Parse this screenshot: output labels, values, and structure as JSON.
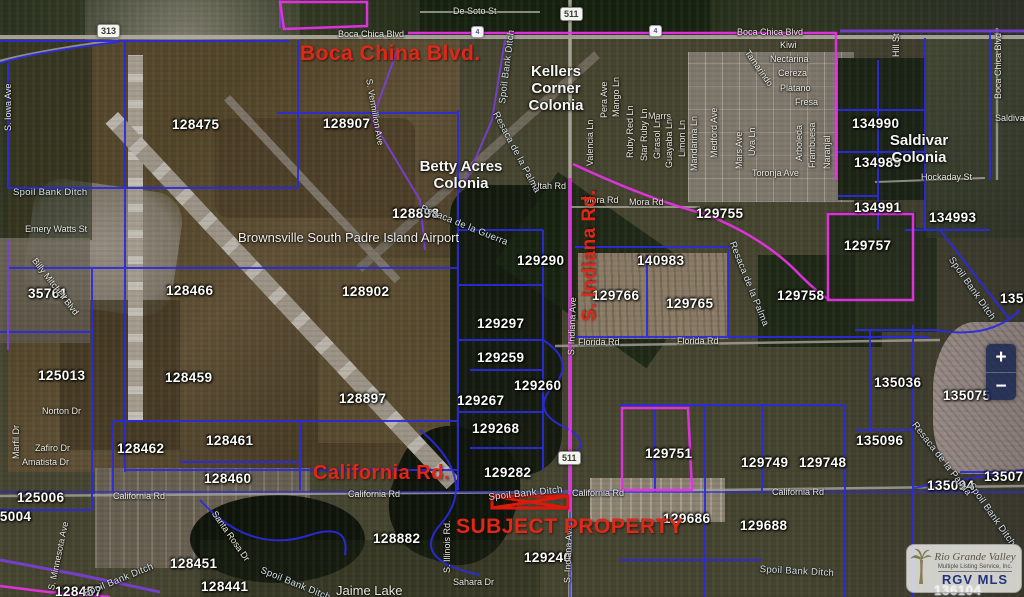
{
  "title": "RGV MLS parcel map - Brownsville South Padre Island Airport area",
  "colors": {
    "parcel_line": "#2b2be0",
    "highlight_magenta": "#e632e6",
    "purple_line": "#7a3fd8",
    "road_label_red": "#e02818",
    "shield_bg": "#f4f4ee",
    "subject_red": "#e0180c"
  },
  "controls": {
    "zoom_in": "+",
    "zoom_out": "−"
  },
  "logo": {
    "name": "Rio Grande Valley",
    "sub": "Multiple Listing Service, Inc.",
    "abbr": "RGV MLS"
  },
  "labels": {
    "reds": [
      {
        "t": "Boca China Blvd.",
        "x": 300,
        "y": 42,
        "s": 21
      },
      {
        "t": "California Rd.",
        "x": 313,
        "y": 462,
        "s": 20
      },
      {
        "t": "SUBJECT PROPERTY",
        "x": 456,
        "y": 515,
        "s": 21
      },
      {
        "t": "S. Indiana Rd.",
        "x": 579,
        "y": 322,
        "r": -90,
        "s": 19
      }
    ],
    "parcels": [
      {
        "t": "128475",
        "x": 172,
        "y": 117
      },
      {
        "t": "128907",
        "x": 323,
        "y": 116
      },
      {
        "t": "128898",
        "x": 392,
        "y": 206
      },
      {
        "t": "128466",
        "x": 166,
        "y": 283
      },
      {
        "t": "128902",
        "x": 342,
        "y": 284
      },
      {
        "t": "35761",
        "x": 28,
        "y": 286
      },
      {
        "t": "125013",
        "x": 38,
        "y": 368
      },
      {
        "t": "128459",
        "x": 165,
        "y": 370
      },
      {
        "t": "128897",
        "x": 339,
        "y": 391
      },
      {
        "t": "129290",
        "x": 517,
        "y": 253
      },
      {
        "t": "129297",
        "x": 477,
        "y": 316
      },
      {
        "t": "129259",
        "x": 477,
        "y": 350
      },
      {
        "t": "129260",
        "x": 514,
        "y": 378
      },
      {
        "t": "129267",
        "x": 457,
        "y": 393
      },
      {
        "t": "129268",
        "x": 472,
        "y": 421
      },
      {
        "t": "129282",
        "x": 484,
        "y": 465
      },
      {
        "t": "128462",
        "x": 117,
        "y": 441
      },
      {
        "t": "128461",
        "x": 206,
        "y": 433
      },
      {
        "t": "128460",
        "x": 204,
        "y": 471
      },
      {
        "t": "125006",
        "x": 17,
        "y": 490
      },
      {
        "t": "125004",
        "x": -16,
        "y": 509
      },
      {
        "t": "128451",
        "x": 170,
        "y": 556
      },
      {
        "t": "128441",
        "x": 201,
        "y": 579
      },
      {
        "t": "128457",
        "x": 55,
        "y": 584
      },
      {
        "t": "128882",
        "x": 373,
        "y": 531
      },
      {
        "t": "129240",
        "x": 524,
        "y": 550
      },
      {
        "t": "140983",
        "x": 637,
        "y": 253
      },
      {
        "t": "129766",
        "x": 592,
        "y": 288
      },
      {
        "t": "129765",
        "x": 666,
        "y": 296
      },
      {
        "t": "129755",
        "x": 696,
        "y": 206
      },
      {
        "t": "129758",
        "x": 777,
        "y": 288
      },
      {
        "t": "129757",
        "x": 844,
        "y": 238
      },
      {
        "t": "134990",
        "x": 852,
        "y": 116
      },
      {
        "t": "134989",
        "x": 854,
        "y": 155
      },
      {
        "t": "134991",
        "x": 854,
        "y": 200
      },
      {
        "t": "134993",
        "x": 929,
        "y": 210
      },
      {
        "t": "135036",
        "x": 874,
        "y": 375
      },
      {
        "t": "135075",
        "x": 943,
        "y": 388
      },
      {
        "t": "135096",
        "x": 856,
        "y": 433
      },
      {
        "t": "135094",
        "x": 927,
        "y": 478
      },
      {
        "t": "135073",
        "x": 984,
        "y": 469
      },
      {
        "t": "1350",
        "x": 1000,
        "y": 291
      },
      {
        "t": "129751",
        "x": 645,
        "y": 446
      },
      {
        "t": "129749",
        "x": 741,
        "y": 455
      },
      {
        "t": "129748",
        "x": 799,
        "y": 455
      },
      {
        "t": "129686",
        "x": 663,
        "y": 511
      },
      {
        "t": "129688",
        "x": 740,
        "y": 518
      },
      {
        "t": "136104",
        "x": 934,
        "y": 583,
        "style": "outline"
      }
    ],
    "streets": [
      {
        "t": "De Soto St",
        "x": 453,
        "y": 6
      },
      {
        "t": "Boca Chica Blvd",
        "x": 338,
        "y": 29
      },
      {
        "t": "Boca Chica Blvd",
        "x": 737,
        "y": 27
      },
      {
        "t": "Boca Chica Blvd",
        "x": 993,
        "y": 99,
        "r": -90
      },
      {
        "t": "Utah Rd",
        "x": 533,
        "y": 181
      },
      {
        "t": "Mora Rd",
        "x": 584,
        "y": 195
      },
      {
        "t": "Mora Rd",
        "x": 629,
        "y": 197
      },
      {
        "t": "Florida Rd",
        "x": 578,
        "y": 337
      },
      {
        "t": "Florida Rd",
        "x": 677,
        "y": 336
      },
      {
        "t": "Hockaday St",
        "x": 921,
        "y": 172
      },
      {
        "t": "Marrs",
        "x": 648,
        "y": 111
      },
      {
        "t": "California Rd",
        "x": 113,
        "y": 491
      },
      {
        "t": "California Rd",
        "x": 348,
        "y": 489
      },
      {
        "t": "California Rd",
        "x": 572,
        "y": 488
      },
      {
        "t": "California Rd",
        "x": 772,
        "y": 487
      },
      {
        "t": "Norton Dr",
        "x": 42,
        "y": 406
      },
      {
        "t": "Zafiro Dr",
        "x": 35,
        "y": 443
      },
      {
        "t": "Amatista Dr",
        "x": 22,
        "y": 457
      },
      {
        "t": "Marfil Dr",
        "x": 11,
        "y": 459,
        "r": -90
      },
      {
        "t": "Emery Watts St",
        "x": 25,
        "y": 224
      },
      {
        "t": "Billy Mitchell Blvd",
        "x": 38,
        "y": 256,
        "r": 52
      },
      {
        "t": "S. Vermillion Ave",
        "x": 374,
        "y": 78,
        "r": 80
      },
      {
        "t": "S. Iowa Ave",
        "x": 3,
        "y": 131,
        "r": -90
      },
      {
        "t": "S. Minnesota Ave",
        "x": 46,
        "y": 589,
        "r": -78
      },
      {
        "t": "S. Illinois Rd.",
        "x": 442,
        "y": 573,
        "r": -90
      },
      {
        "t": "S. Indiana Ave",
        "x": 566,
        "y": 355,
        "r": -88
      },
      {
        "t": "S. Indiana Ave",
        "x": 562,
        "y": 583,
        "r": -88
      },
      {
        "t": "Santa Rosa Dr",
        "x": 218,
        "y": 509,
        "r": 55
      },
      {
        "t": "Sahara Dr",
        "x": 453,
        "y": 577
      },
      {
        "t": "Jaime Lake",
        "x": 336,
        "y": 583,
        "s": 13
      },
      {
        "t": "Hill St",
        "x": 891,
        "y": 57,
        "r": -90
      },
      {
        "t": "Saldivar",
        "x": 995,
        "y": 113
      },
      {
        "t": "Toronja Ave",
        "x": 752,
        "y": 168
      },
      {
        "t": "Kiwi",
        "x": 780,
        "y": 40
      },
      {
        "t": "Nectarina",
        "x": 770,
        "y": 54
      },
      {
        "t": "Cereza",
        "x": 778,
        "y": 68
      },
      {
        "t": "Platano",
        "x": 780,
        "y": 83
      },
      {
        "t": "Fresa",
        "x": 795,
        "y": 97
      },
      {
        "t": "Tamarindo",
        "x": 751,
        "y": 48,
        "r": 55
      },
      {
        "t": "Medford Ave",
        "x": 709,
        "y": 158,
        "r": -90
      },
      {
        "t": "Mars Ave",
        "x": 734,
        "y": 169,
        "r": -90
      },
      {
        "t": "Uva Ln",
        "x": 747,
        "y": 156,
        "r": -90
      },
      {
        "t": "Arboleda",
        "x": 794,
        "y": 161,
        "r": -90
      },
      {
        "t": "Frambuesa",
        "x": 807,
        "y": 168,
        "r": -90
      },
      {
        "t": "Naranjal",
        "x": 822,
        "y": 169,
        "r": -90
      },
      {
        "t": "Valencia Ln",
        "x": 585,
        "y": 166,
        "r": -90
      },
      {
        "t": "Pera Ave",
        "x": 599,
        "y": 118,
        "r": -90
      },
      {
        "t": "Mango Ln",
        "x": 611,
        "y": 117,
        "r": -90
      },
      {
        "t": "Ruby Red Ln",
        "x": 625,
        "y": 158,
        "r": -90
      },
      {
        "t": "Star Ruby Ln",
        "x": 639,
        "y": 161,
        "r": -90
      },
      {
        "t": "Girasol Ln",
        "x": 652,
        "y": 159,
        "r": -90
      },
      {
        "t": "Guayaba Ln",
        "x": 664,
        "y": 168,
        "r": -90
      },
      {
        "t": "Limon Ln",
        "x": 677,
        "y": 157,
        "r": -90
      },
      {
        "t": "Mandarina Ln",
        "x": 689,
        "y": 171,
        "r": -90
      }
    ],
    "waters": [
      {
        "t": "Spoil Bank Ditch",
        "x": 13,
        "y": 187
      },
      {
        "t": "Spoil Bank Ditch",
        "x": 497,
        "y": 103,
        "r": -83
      },
      {
        "t": "Resaca de la Palma",
        "x": 500,
        "y": 110,
        "r": 62
      },
      {
        "t": "Resaca de la Guerra",
        "x": 423,
        "y": 203,
        "r": 22
      },
      {
        "t": "Resaca de la Palma",
        "x": 737,
        "y": 240,
        "r": 68
      },
      {
        "t": "Spoil Bank Ditch",
        "x": 955,
        "y": 255,
        "r": 55
      },
      {
        "t": "Resaca de la Palma",
        "x": 918,
        "y": 420,
        "r": 52
      },
      {
        "t": "Spoil Bank Ditch",
        "x": 488,
        "y": 492,
        "r": -6
      },
      {
        "t": "Spoil Bank Ditch",
        "x": 760,
        "y": 564,
        "r": 3
      },
      {
        "t": "Spoil Bank Ditch",
        "x": 82,
        "y": 589,
        "r": -22
      },
      {
        "t": "Spoil Bank Ditch",
        "x": 263,
        "y": 565,
        "r": 22
      },
      {
        "t": "Spoil Bank Ditch",
        "x": 975,
        "y": 481,
        "r": 55
      }
    ],
    "areas": [
      {
        "t": "Kellers\nCorner\nColonia",
        "x": 556,
        "y": 64
      },
      {
        "t": "Betty Acres\nColonia",
        "x": 461,
        "y": 159
      },
      {
        "t": "Saldivar\nColonia",
        "x": 919,
        "y": 133
      }
    ],
    "pois": [
      {
        "t": "Brownsville South Padre Island Airport",
        "x": 238,
        "y": 230
      }
    ],
    "shields": [
      {
        "t": "313",
        "x": 97,
        "y": 24
      },
      {
        "t": "511",
        "x": 560,
        "y": 7
      },
      {
        "t": "511",
        "x": 558,
        "y": 451
      }
    ],
    "badges": [
      {
        "t": "4",
        "x": 471,
        "y": 26
      },
      {
        "t": "4",
        "x": 649,
        "y": 25
      }
    ]
  }
}
